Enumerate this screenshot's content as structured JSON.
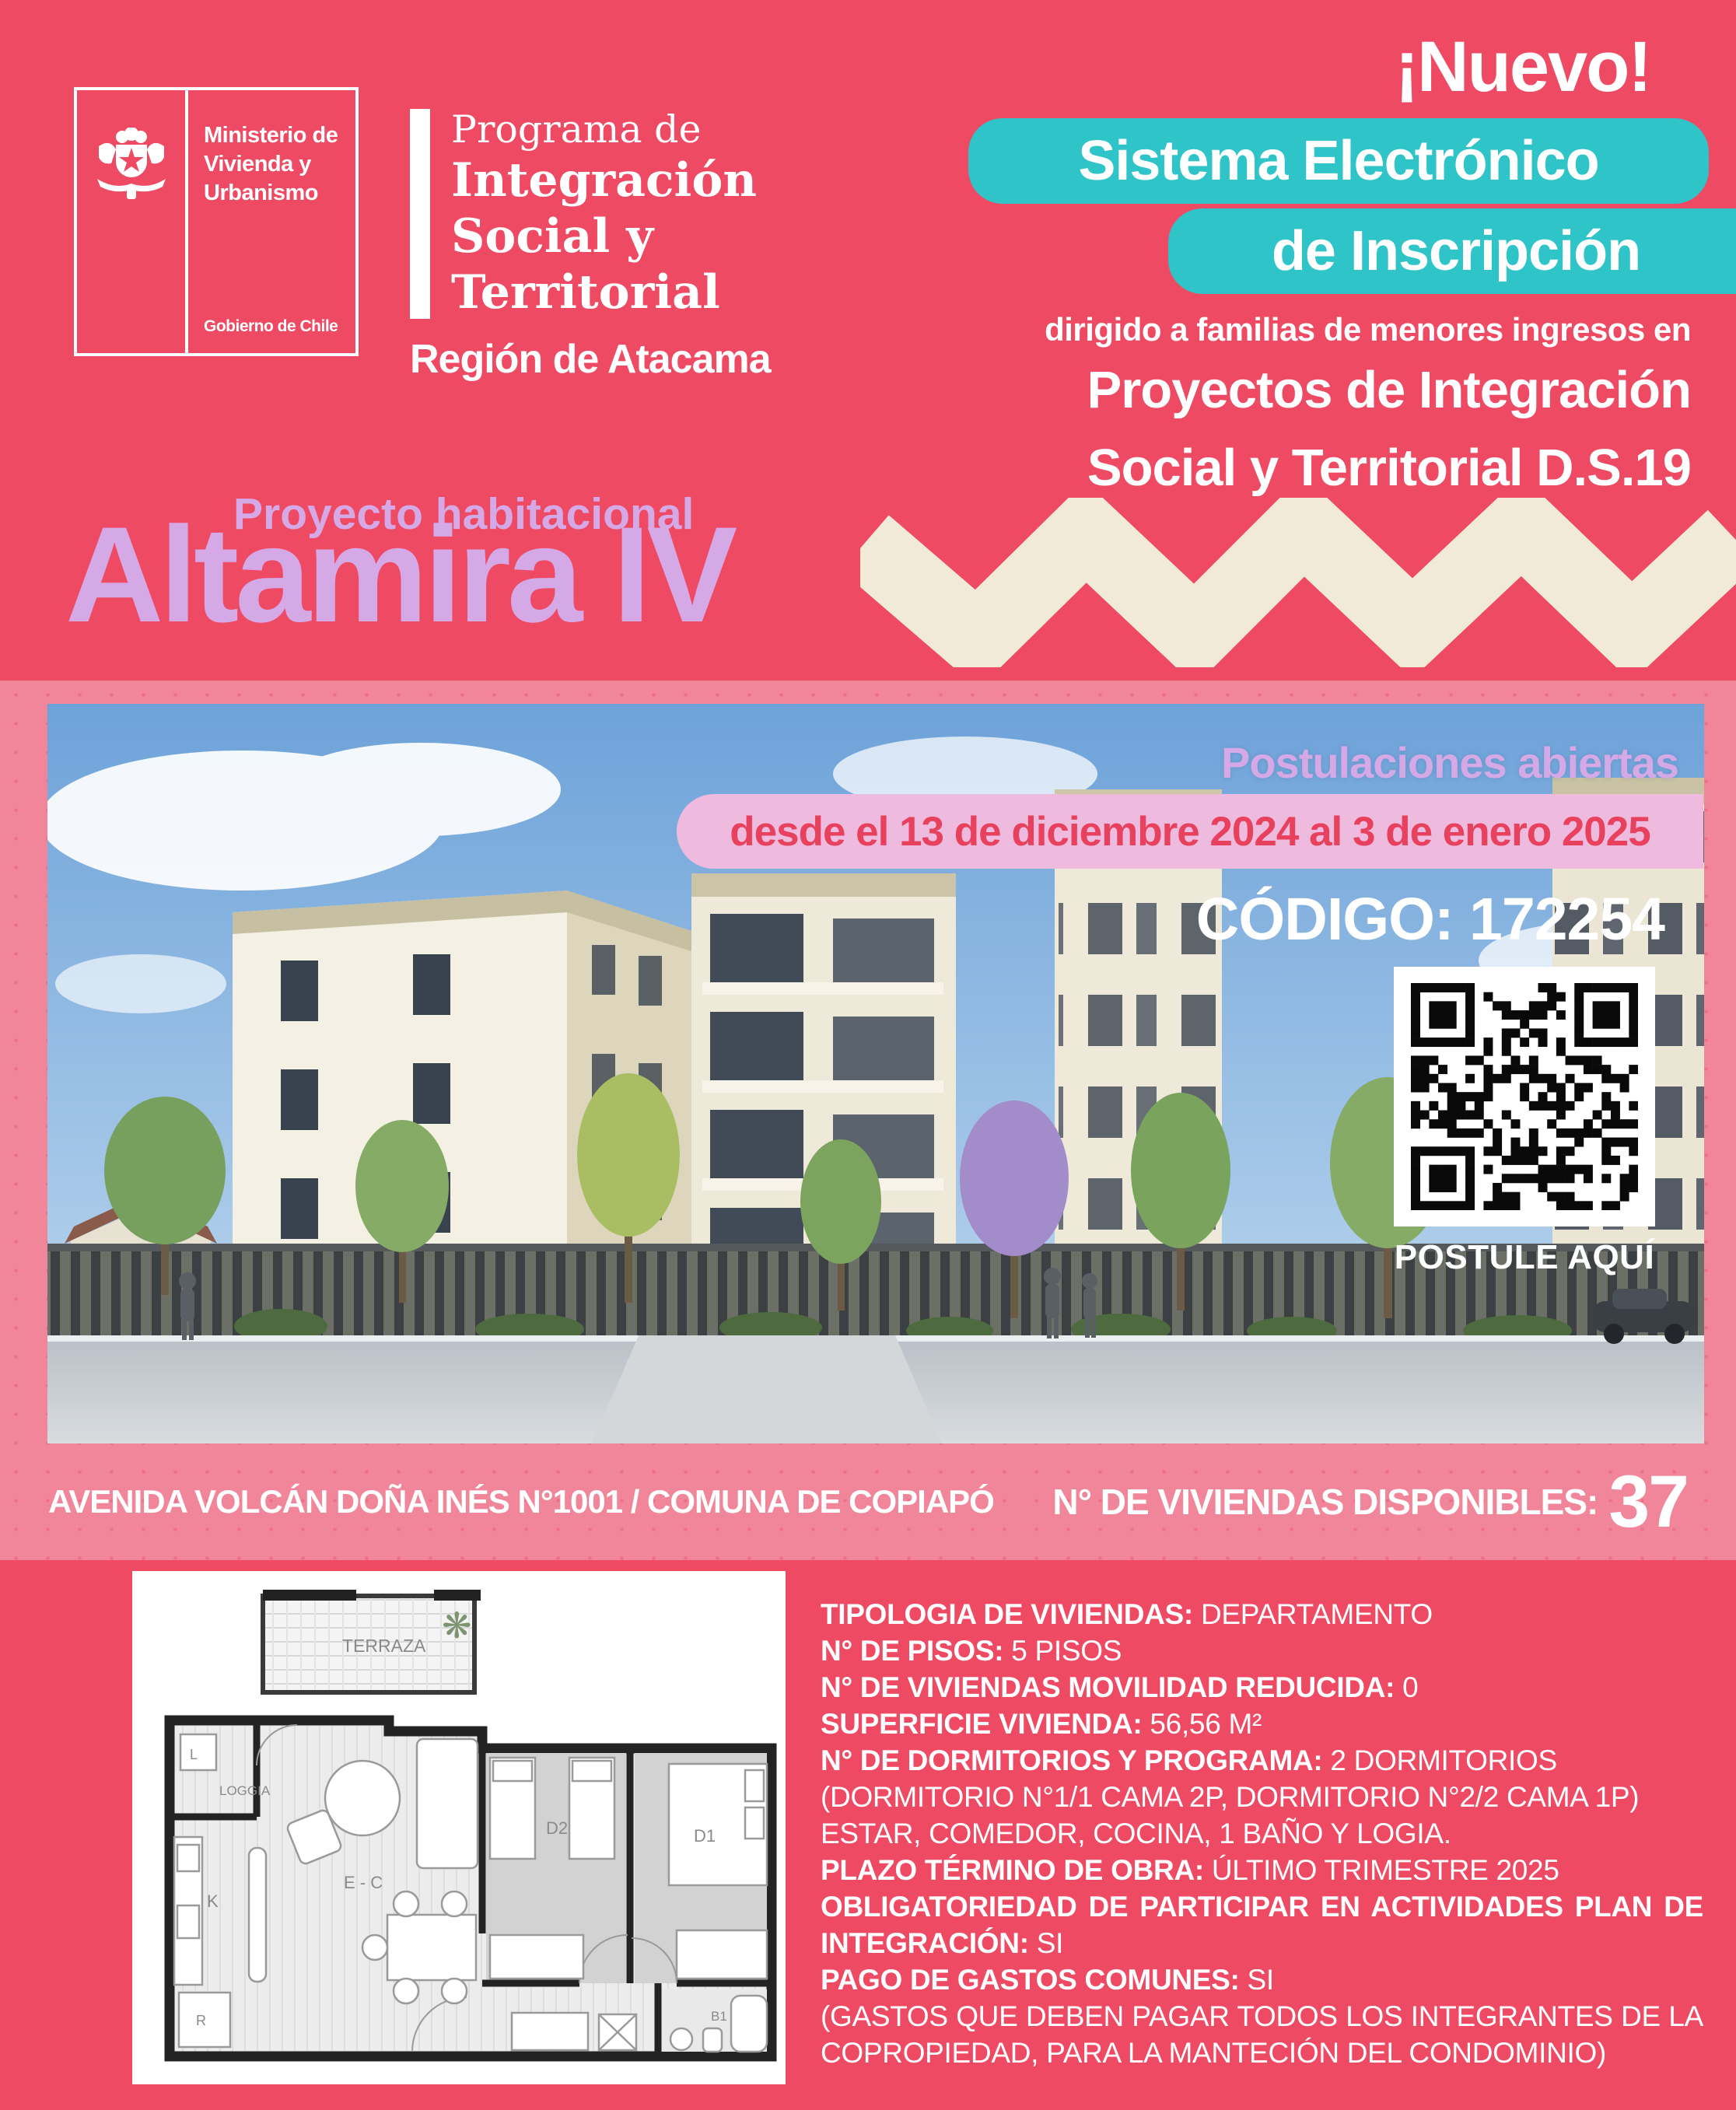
{
  "colors": {
    "primary_pink": "#ee4a63",
    "frame_pink": "#f1859a",
    "lavender": "#d5a9e6",
    "teal": "#2fc4c7",
    "banner_bg": "#eebade",
    "banner_text": "#e8415e",
    "cream": "#f2ead9"
  },
  "logo": {
    "line1": "Ministerio de",
    "line2": "Vivienda y",
    "line3": "Urbanismo",
    "government": "Gobierno de Chile",
    "emblem": "chile-coat-of-arms-icon"
  },
  "program": {
    "eyebrow": "Programa de",
    "name_line1": "Integración",
    "name_line2": "Social y",
    "name_line3": "Territorial",
    "region": "Región de Atacama"
  },
  "promo": {
    "nuevo": "¡Nuevo!",
    "system_line1": "Sistema Electrónico",
    "system_line2": "de Inscripción",
    "dirigido": "dirigido a familias de menores ingresos en",
    "target_line1": "Proyectos de Integración",
    "target_line2": "Social y Territorial D.S.19"
  },
  "project": {
    "eyebrow": "Proyecto habitacional",
    "name": "Altamira IV"
  },
  "hero": {
    "open_label": "Postulaciones abiertas",
    "date_range": "desde el 13 de diciembre 2024 al 3 de enero 2025",
    "code": "CÓDIGO: 172254",
    "qr_caption": "POSTULE AQUÍ",
    "qr": "qr-code-postulacion"
  },
  "address_bar": {
    "address": "AVENIDA VOLCÁN DOÑA INÉS N°1001 / COMUNA DE COPIAPÓ",
    "units_label": "N° DE VIVIENDAS DISPONIBLES:",
    "units_value": "37"
  },
  "floorplan": {
    "terraza": "TERRAZA",
    "loggia": "LOGGIA",
    "l": "L",
    "k": "K",
    "r": "R",
    "ec": "E - C",
    "d2": "D2",
    "d1": "D1",
    "b1": "B1"
  },
  "details": {
    "rows": [
      {
        "label": "TIPOLOGIA DE VIVIENDAS:",
        "value": "DEPARTAMENTO",
        "just": false
      },
      {
        "label": "N° DE PISOS:",
        "value": "5 PISOS",
        "just": false
      },
      {
        "label": "N° DE VIVIENDAS MOVILIDAD REDUCIDA:",
        "value": "0",
        "just": false
      },
      {
        "label": "SUPERFICIE VIVIENDA:",
        "value": "56,56 M²",
        "just": false
      },
      {
        "label": "N° DE DORMITORIOS Y PROGRAMA:",
        "value": "2 DORMITORIOS (DORMITORIO N°1/1 CAMA 2P, DORMITORIO N°2/2 CAMA 1P) ESTAR, COMEDOR, COCINA, 1 BAÑO Y LOGIA.",
        "just": false
      },
      {
        "label": "PLAZO TÉRMINO DE OBRA:",
        "value": "ÚLTIMO TRIMESTRE 2025",
        "just": false
      },
      {
        "label": "OBLIGATORIEDAD DE PARTICIPAR EN ACTIVIDADES PLAN DE INTEGRACIÓN:",
        "value": "SI",
        "just": true
      },
      {
        "label": "PAGO DE GASTOS COMUNES:",
        "value": "SI",
        "just": false
      },
      {
        "label": "",
        "value": "(GASTOS QUE DEBEN PAGAR TODOS LOS INTEGRANTES DE LA COPROPIEDAD, PARA LA MANTECIÓN DEL CONDOMINIO)",
        "just": true
      }
    ]
  }
}
